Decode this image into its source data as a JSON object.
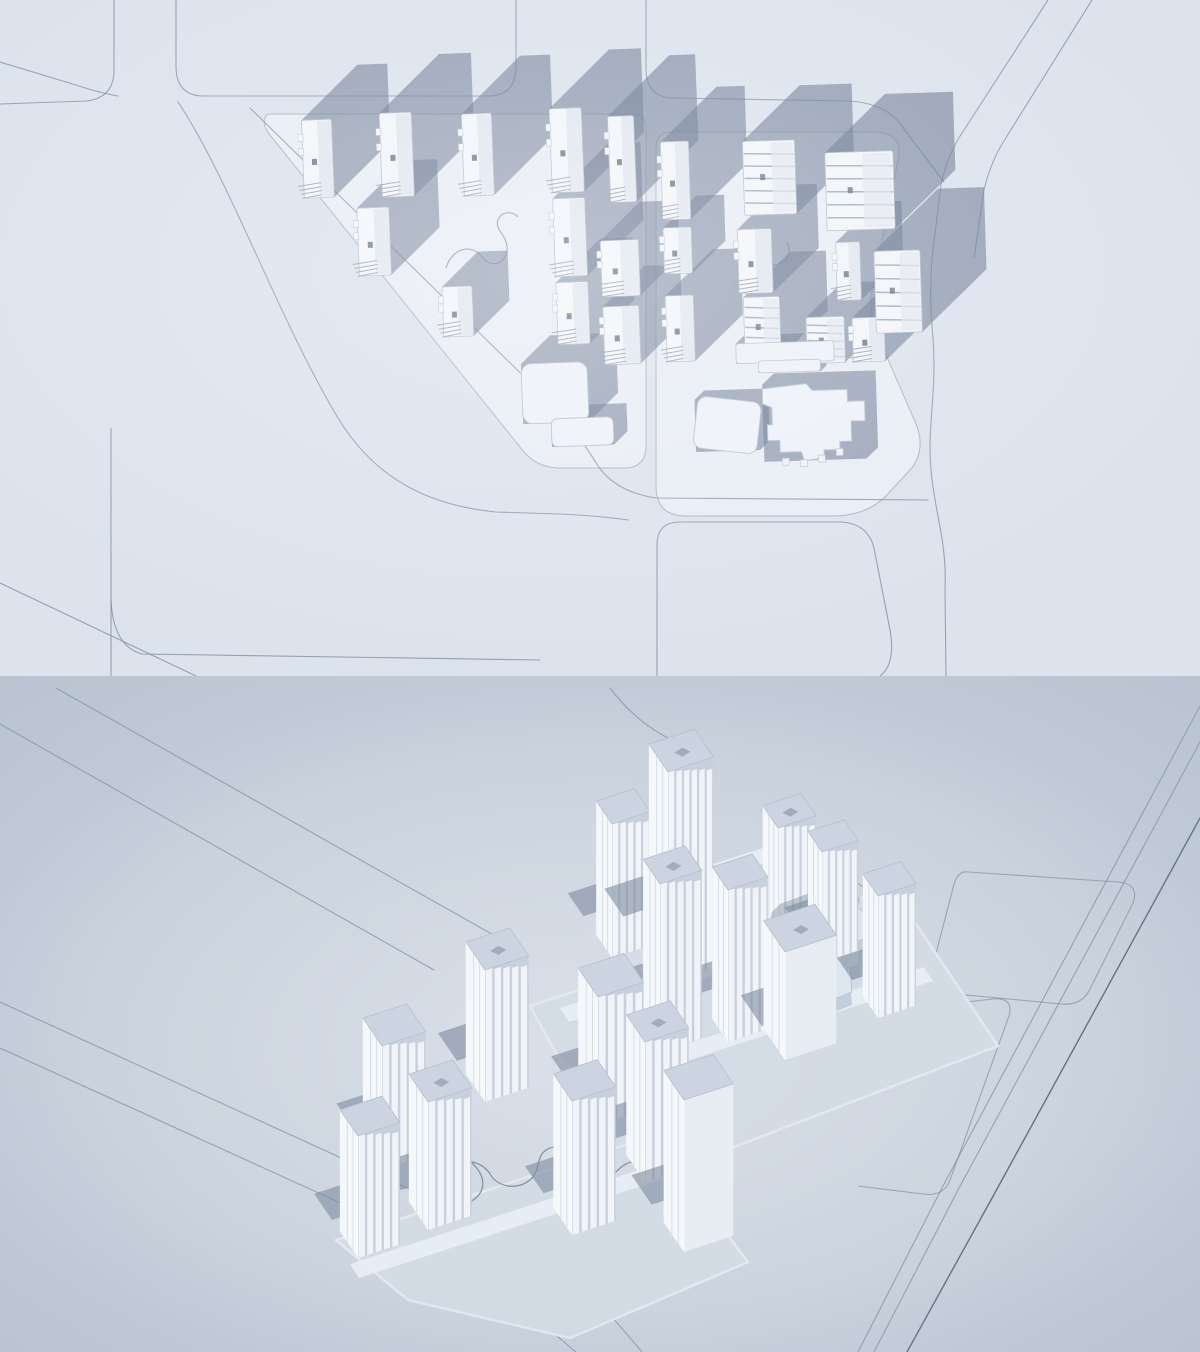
{
  "canvas": {
    "width": 1200,
    "height": 1352,
    "split_y": 676
  },
  "palette": {
    "top_bg": "#dce3ed",
    "top_plot": "#e9eef6",
    "plot_edge": "#a8b3c2",
    "top_road": "#8290a3",
    "shadow": "#68768f",
    "shadow_opacity": 0.58,
    "bldg": "#f2f5f9",
    "bldg_edge": "#b4bfce",
    "roof_shade": "#e1e7f0",
    "fin": "#97a3b4",
    "core": "#5f6c80",
    "lowrise": "#edf1f8",
    "walk_top": "#8a96a8",
    "bot_bg": "#c5ceda",
    "bot_glow": "#edf1f7",
    "bot_road": "#7e8b9c",
    "bot_road_major": "#566779",
    "podium": "#d4dce6",
    "podium_edge": "#e3e9f1",
    "terrace": "#e9eef5",
    "face_left": "#f5f8fb",
    "face_right": "#c7d0dc",
    "plain_face": "#e8edf4",
    "fin_ridge": "#f0f4f8",
    "roof_top": "#cbd4e0",
    "roof_edge": "#b6c0ce",
    "roof_unit": "#9aa6b7",
    "cast_shadow": "#7e8b9f",
    "cast_opacity": 0.6,
    "walkway": "#75828f",
    "vignette": "#93a0b2"
  },
  "top_view": {
    "plots": [
      "M268,114 L630,114 Q646,114 646,128 L646,446 Q646,468 624,468 L560,468 Q538,468 524,452 L274,140 Q258,122 268,114 Z",
      "M672,132 L876,132 Q904,134 898,160 L872,290 Q868,312 877,334 L916,424 Q926,448 912,468 L884,498 Q864,516 832,516 L686,516 Q656,516 656,486 L656,148 Q656,132 672,132 Z"
    ],
    "roads": [
      "M0,104 L86,101 Q114,98 114,70 L114,0",
      "M0,62 L76,85 Q100,93 118,96",
      "M176,0 L176,66 Q176,96 204,96 L488,96 Q516,96 516,66 L516,0",
      "M646,0 L646,68 Q646,98 674,98 L848,101 Q888,103 904,129 L944,182",
      "M1048,0 L964,130 Q947,155 941,185 L932,258 Q929,300 933,338 C937,395 927,425 931,470 C935,515 947,540 945,590 L946,676",
      "M1092,0 L1007,136 Q991,160 984,190 L974,258",
      "M250,108 L552,404 Q580,436 598,466 Q616,492 656,498 L928,500",
      "M178,102 C230,180 278,318 338,418 C378,484 436,506 496,512 L560,514 Q600,516 628,520",
      "M111,428 L111,676",
      "M111,600 Q113,646 142,654 L540,660",
      "M0,583 L196,676",
      "M657,676 L657,545 Q657,522 680,522 L842,522 Q868,524 874,548 L890,630 Q896,664 880,676"
    ],
    "squiggles": [
      "M446,268 c6,-20 26,-25 36,-11 c8,11 23,8 25,-6 c2,-15 -13,-21 -9,-31 c3,-8 14,-10 20,-3",
      "M737,240 c13,-8 25,-1 24,11 c-1,10 8,16 18,13 c10,-3 12,-13 8,-22 m-48,30 c10,9 26,7 31,-3"
    ],
    "clusters": [
      {
        "name": "west-residential-cluster",
        "rotate": [
          -2.2,
          470,
          290
        ],
        "slabs": [
          [
            308,
            114,
            30,
            78
          ],
          [
            386,
            110,
            32,
            84
          ],
          [
            468,
            114,
            30,
            82
          ],
          [
            556,
            112,
            32,
            84
          ],
          [
            614,
            122,
            26,
            86
          ],
          [
            360,
            204,
            32,
            68
          ],
          [
            556,
            202,
            32,
            78
          ],
          [
            602,
            246,
            38,
            56
          ],
          [
            442,
            286,
            30,
            50
          ],
          [
            556,
            286,
            32,
            62
          ],
          [
            602,
            312,
            36,
            58
          ]
        ],
        "fluted": [],
        "bars": [],
        "lowrise": [
          [
            518,
            366,
            66,
            60,
            30,
            10
          ],
          [
            546,
            422,
            62,
            28,
            14,
            6
          ]
        ],
        "flatsq": null,
        "mall": null
      },
      {
        "name": "east-residential-cluster",
        "rotate": [
          -1.8,
          790,
          320
        ],
        "slabs": [
          [
            666,
            138,
            28,
            78
          ],
          [
            666,
            224,
            28,
            46
          ],
          [
            666,
            292,
            28,
            66
          ],
          [
            740,
            228,
            34,
            64
          ],
          [
            838,
            244,
            24,
            58
          ],
          [
            852,
            320,
            32,
            44
          ]
        ],
        "fluted": [
          [
            748,
            140,
            52,
            74
          ],
          [
            830,
            154,
            68,
            78
          ],
          [
            876,
            254,
            46,
            82
          ],
          [
            744,
            296,
            36,
            60
          ],
          [
            806,
            318,
            38,
            46
          ]
        ],
        "bars": [
          [
            735,
            342,
            98,
            20,
            9,
            3
          ],
          [
            757,
            360,
            62,
            12,
            6,
            3
          ]
        ],
        "lowrise": [],
        "flatsq": [
          692,
          397,
          64,
          52,
          10,
          8
        ],
        "mall": {
          "path": "M760,388 L804,384 L810,391 L845,391 L845,403 L862,403 L862,423 L848,423 L848,443 L836,443 L836,451 L820,451 L820,459 L800,461 L797,452 L776,452 L776,440 L764,440 L764,424 L769,424 L769,407 L760,403 Z",
          "bbox": [
            760,
            384,
            102,
            77
          ],
          "s": 12,
          "teeth": [
            [
              778,
              458
            ],
            [
              796,
              460
            ],
            [
              814,
              456
            ],
            [
              832,
              450
            ]
          ]
        }
      }
    ]
  },
  "bottom_view": {
    "axes": {
      "u": [
        0.95,
        -0.31
      ],
      "r": [
        0.56,
        0.82
      ]
    },
    "roads": [
      {
        "d": "M1200,706 L943,1186 L858,1352",
        "major": false
      },
      {
        "d": "M1200,742 L958,1190 L874,1352",
        "major": false
      },
      {
        "d": "M1200,818 L991,1200 L907,1352",
        "major": true
      },
      {
        "d": "M56,688 L520,950",
        "major": false
      },
      {
        "d": "M0,724 L434,970",
        "major": false
      },
      {
        "d": "M0,1002 L455,1210 Q545,1250 596,1298 L642,1352",
        "major": false
      },
      {
        "d": "M0,1048 L422,1240 Q492,1274 538,1320 L576,1352",
        "major": false
      },
      {
        "d": "M838,872 C868,888 886,902 898,922 C908,940 916,952 930,958",
        "major": false
      },
      {
        "d": "M610,688 C628,712 650,730 676,742",
        "major": false
      }
    ],
    "blocks": [
      "M968,872 L1118,882 Q1140,884 1133,903 L1090,989 Q1082,1006 1061,1004 L945,993 Q925,991 931,973 L953,888 Q957,870 968,872 Z",
      "M876,1012 L993,999 Q1014,997 1009,1016 L950,1180 Q944,1197 923,1194 L858,1186"
    ],
    "podiums": [
      "M530,1006 L892,888 L998,1046 L700,1160 L560,1060 Z",
      "M336,1240 L652,1136 L748,1262 L570,1338 L408,1300 Z"
    ],
    "terraces": [
      "M688,872 L810,833 L817,846 L695,885 Z",
      "M560,1008 L902,897 L911,911 L569,1022 Z",
      "M612,1068 L924,967 L933,981 L621,1082 Z",
      "M350,1264 L700,1150 L709,1164 L359,1278 Z"
    ],
    "squiggles": [
      "M616,906 c10,-14 26,-11 29,1 c3,11 15,13 23,5 c8,-8 3,-19 13,-24 c7,-3 14,1 15,8",
      "M468,1160 c28,20 12,46 -12,44 c-22,-2 -26,-26 -8,-38 c14,-9 34,-5 42,8 c8,14 28,16 40,6 c12,-10 4,-26 20,-32 c14,-5 28,4 26,16 c-2,14 14,22 28,16 c14,-6 18,-20 34,-18"
    ],
    "towers": [
      {
        "f": [
          668,
          982
        ],
        "h": 210,
        "wu": 48,
        "wr": 34,
        "fins": 6,
        "type": "fluted",
        "unit": true
      },
      {
        "f": [
          612,
          958
        ],
        "h": 134,
        "wu": 40,
        "wr": 28,
        "fins": 5,
        "type": "fluted",
        "unit": false
      },
      {
        "f": [
          778,
          948
        ],
        "h": 120,
        "wu": 40,
        "wr": 27,
        "fins": 5,
        "type": "fluted",
        "unit": true
      },
      {
        "f": [
          822,
          962
        ],
        "h": 110,
        "wu": 38,
        "wr": 25,
        "fins": 5,
        "type": "fluted",
        "unit": false
      },
      {
        "f": [
          660,
          1052
        ],
        "h": 168,
        "wu": 44,
        "wr": 30,
        "fins": 5,
        "type": "fluted",
        "unit": true
      },
      {
        "f": [
          728,
          1042
        ],
        "h": 152,
        "wu": 42,
        "wr": 28,
        "fins": 5,
        "type": "fluted",
        "unit": false
      },
      {
        "f": [
          878,
          1018
        ],
        "h": 122,
        "wu": 40,
        "wr": 27,
        "fins": 5,
        "type": "fluted",
        "unit": false
      },
      {
        "f": [
          785,
          1060
        ],
        "h": 108,
        "wu": 54,
        "wr": 38,
        "fins": 0,
        "type": "plain",
        "unit": true
      },
      {
        "f": [
          485,
          1102
        ],
        "h": 132,
        "wu": 46,
        "wr": 34,
        "fins": 5,
        "type": "fluted",
        "unit": true
      },
      {
        "f": [
          598,
          1125
        ],
        "h": 128,
        "wu": 48,
        "wr": 35,
        "fins": 5,
        "type": "fluted",
        "unit": false
      },
      {
        "f": [
          645,
          1182
        ],
        "h": 140,
        "wu": 46,
        "wr": 33,
        "fins": 5,
        "type": "fluted",
        "unit": true
      },
      {
        "f": [
          382,
          1170
        ],
        "h": 124,
        "wu": 46,
        "wr": 34,
        "fins": 5,
        "type": "fluted",
        "unit": false
      },
      {
        "f": [
          428,
          1230
        ],
        "h": 128,
        "wu": 46,
        "wr": 34,
        "fins": 5,
        "type": "fluted",
        "unit": true
      },
      {
        "f": [
          572,
          1235
        ],
        "h": 134,
        "wu": 46,
        "wr": 33,
        "fins": 5,
        "type": "fluted",
        "unit": false
      },
      {
        "f": [
          358,
          1258
        ],
        "h": 122,
        "wu": 44,
        "wr": 32,
        "fins": 5,
        "type": "fluted",
        "unit": false
      },
      {
        "f": [
          684,
          1252
        ],
        "h": 152,
        "wu": 52,
        "wr": 36,
        "fins": 0,
        "type": "plain",
        "unit": false
      }
    ],
    "mall": {
      "roof": "M792,922 L846,902 L872,916 L866,938 L858,941 L860,964 L850,968 L852,992 L822,1004 L800,1010 L786,998 L788,966 L780,948 L784,930 Z",
      "drop": 13,
      "sort_y": 960
    }
  }
}
